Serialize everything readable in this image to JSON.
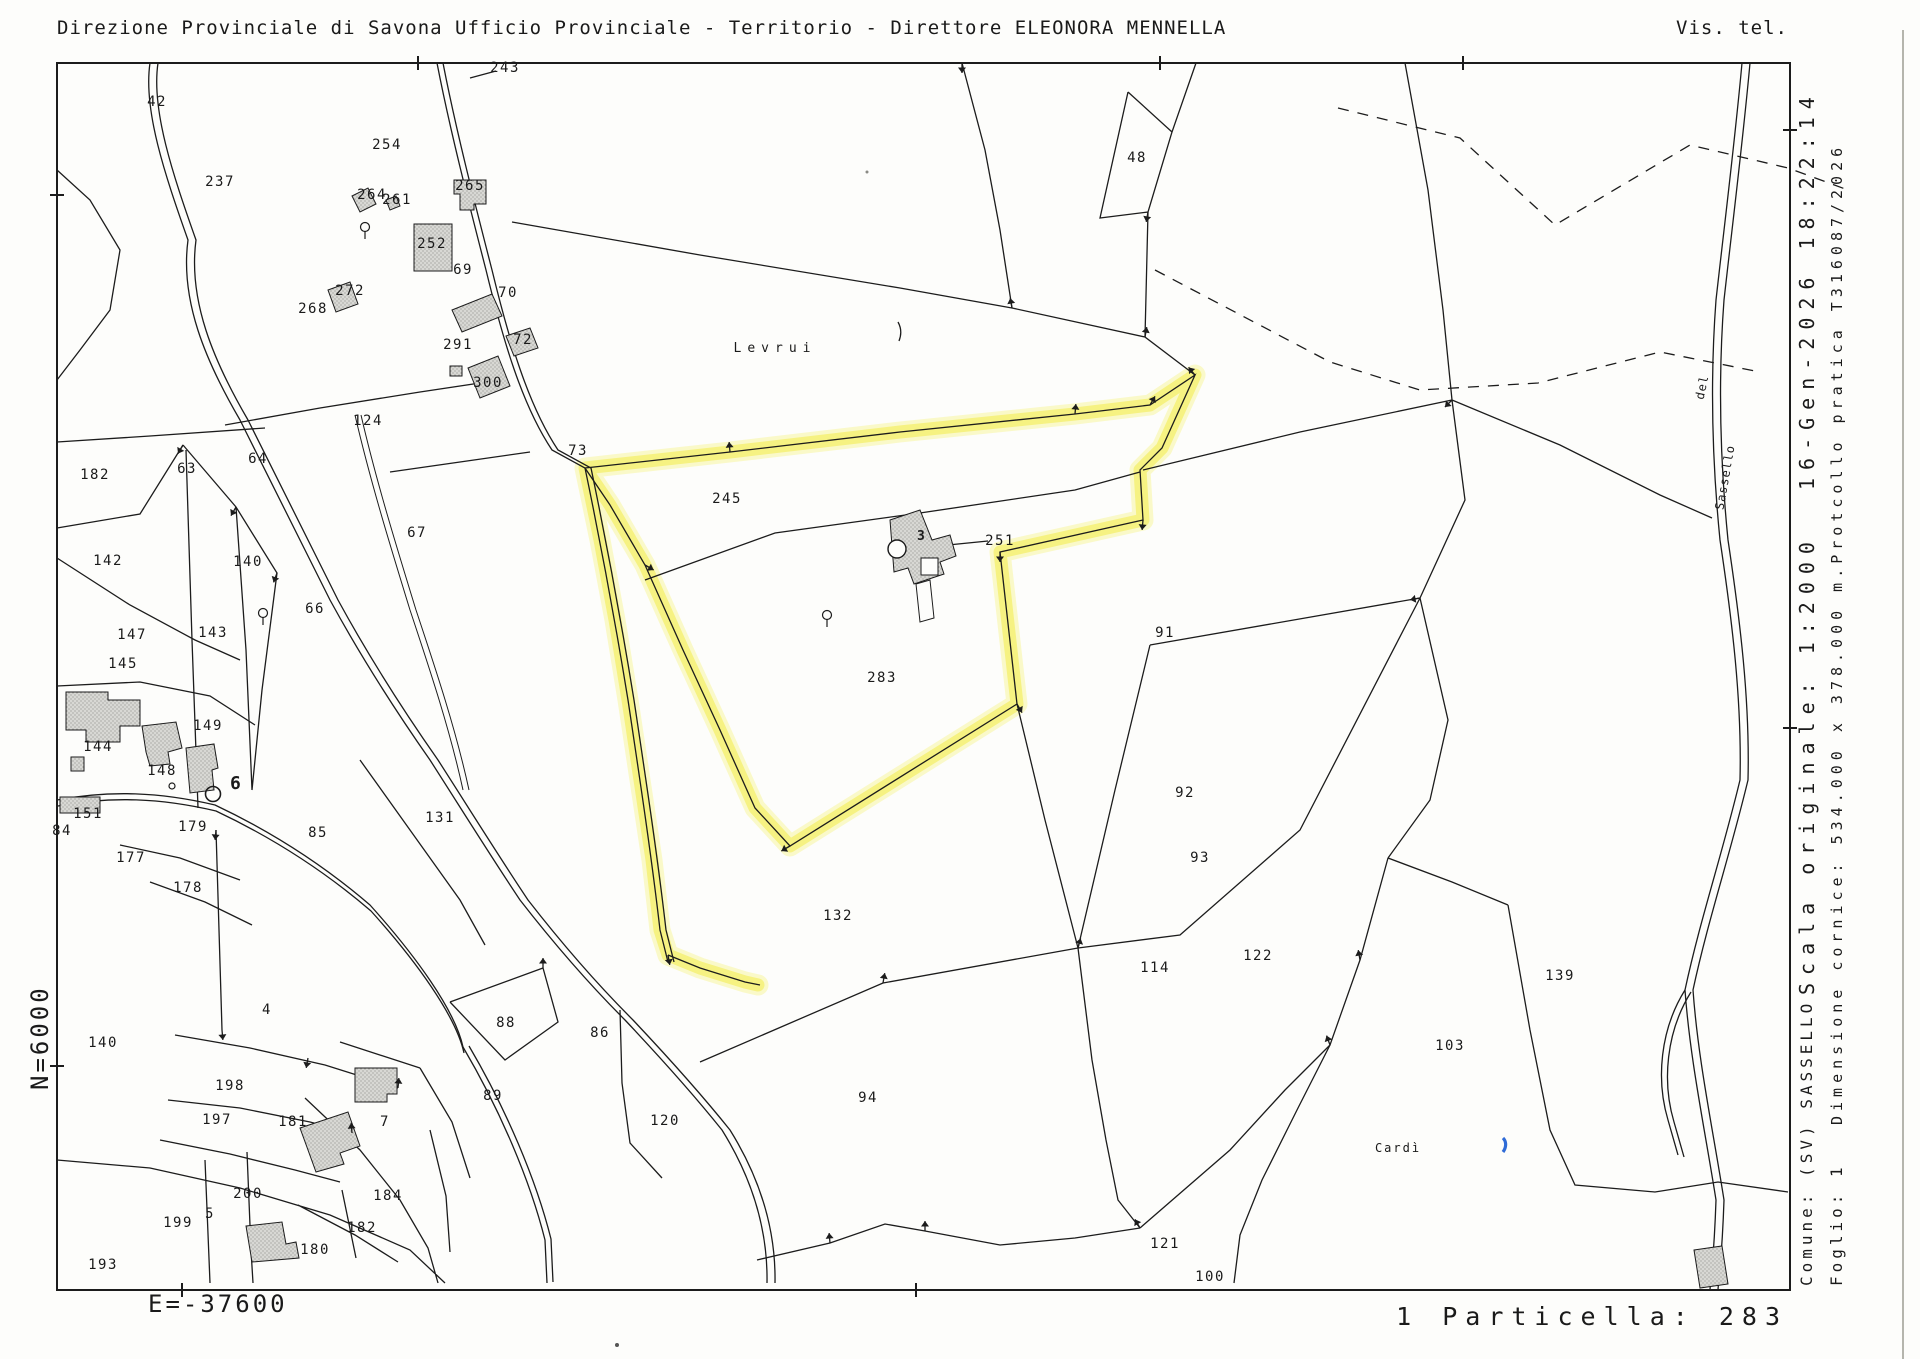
{
  "header": {
    "left": "Direzione Provinciale di Savona  Ufficio Provinciale - Territorio - Direttore ELEONORA MENNELLA",
    "right": "Vis. tel."
  },
  "margins": {
    "north_label": "N=6000",
    "east_label": "E=-37600",
    "datetime_label": "16-Gen-2026 18:22:14",
    "scale_label": "Scala originale: 1:2000",
    "frame_size_label": "Dimensione cornice: 534.000 x 378.000 m.Protcollo pratica T316087/2026",
    "comune_label": "Comune: (SV) SASSELLO",
    "foglio_label": "Foglio: 1",
    "selection_label": "1 Particella: 283"
  },
  "map": {
    "highlighted_parcel": "283",
    "colors": {
      "highlight_yellow": "#f5f17a",
      "line_black": "#1c1c1c",
      "building_gray": "#d8d8d4",
      "blue_mark": "#2f6bd7",
      "paper": "#fdfdfb"
    },
    "parcel_labels": [
      {
        "id": "42",
        "x": 157,
        "y": 106
      },
      {
        "id": "237",
        "x": 220,
        "y": 186
      },
      {
        "id": "254",
        "x": 387,
        "y": 149
      },
      {
        "id": "264",
        "x": 372,
        "y": 199
      },
      {
        "id": "261",
        "x": 397,
        "y": 204
      },
      {
        "id": "265",
        "x": 470,
        "y": 190
      },
      {
        "id": "252",
        "x": 432,
        "y": 248
      },
      {
        "id": "69",
        "x": 463,
        "y": 274
      },
      {
        "id": "70",
        "x": 508,
        "y": 297
      },
      {
        "id": "272",
        "x": 350,
        "y": 295
      },
      {
        "id": "268",
        "x": 313,
        "y": 313
      },
      {
        "id": "291",
        "x": 458,
        "y": 349
      },
      {
        "id": "72",
        "x": 523,
        "y": 344
      },
      {
        "id": "300",
        "x": 488,
        "y": 387
      },
      {
        "id": "124",
        "x": 368,
        "y": 425
      },
      {
        "id": "243",
        "x": 505,
        "y": 72
      },
      {
        "id": "73",
        "x": 578,
        "y": 455
      },
      {
        "id": "245",
        "x": 727,
        "y": 503
      },
      {
        "id": "251",
        "x": 1000,
        "y": 545
      },
      {
        "id": "283",
        "x": 882,
        "y": 682,
        "size": 20
      },
      {
        "id": "48",
        "x": 1137,
        "y": 162
      },
      {
        "id": "182",
        "x": 95,
        "y": 479
      },
      {
        "id": "63",
        "x": 187,
        "y": 473
      },
      {
        "id": "64",
        "x": 258,
        "y": 463
      },
      {
        "id": "142",
        "x": 108,
        "y": 565
      },
      {
        "id": "140",
        "x": 248,
        "y": 566
      },
      {
        "id": "66",
        "x": 315,
        "y": 613
      },
      {
        "id": "67",
        "x": 417,
        "y": 537
      },
      {
        "id": "147",
        "x": 132,
        "y": 639
      },
      {
        "id": "143",
        "x": 213,
        "y": 637
      },
      {
        "id": "145",
        "x": 123,
        "y": 668
      },
      {
        "id": "149",
        "x": 208,
        "y": 730
      },
      {
        "id": "144",
        "x": 98,
        "y": 751
      },
      {
        "id": "148",
        "x": 162,
        "y": 775
      },
      {
        "id": "151",
        "x": 88,
        "y": 818
      },
      {
        "id": "84",
        "x": 62,
        "y": 835
      },
      {
        "id": "179",
        "x": 193,
        "y": 831
      },
      {
        "id": "177",
        "x": 131,
        "y": 862
      },
      {
        "id": "178",
        "x": 188,
        "y": 892
      },
      {
        "id": "85",
        "x": 318,
        "y": 837
      },
      {
        "id": "131",
        "x": 440,
        "y": 822
      },
      {
        "id": "91",
        "x": 1165,
        "y": 637
      },
      {
        "id": "92",
        "x": 1185,
        "y": 797
      },
      {
        "id": "93",
        "x": 1200,
        "y": 862
      },
      {
        "id": "132",
        "x": 838,
        "y": 920
      },
      {
        "id": "114",
        "x": 1155,
        "y": 972
      },
      {
        "id": "122",
        "x": 1258,
        "y": 960
      },
      {
        "id": "94",
        "x": 868,
        "y": 1102
      },
      {
        "id": "120",
        "x": 665,
        "y": 1125
      },
      {
        "id": "86",
        "x": 600,
        "y": 1037
      },
      {
        "id": "88",
        "x": 506,
        "y": 1027
      },
      {
        "id": "89",
        "x": 493,
        "y": 1100
      },
      {
        "id": "4",
        "x": 267,
        "y": 1014
      },
      {
        "id": "140",
        "x": 103,
        "y": 1047
      },
      {
        "id": "198",
        "x": 230,
        "y": 1090
      },
      {
        "id": "197",
        "x": 217,
        "y": 1124
      },
      {
        "id": "181",
        "x": 293,
        "y": 1126
      },
      {
        "id": "7",
        "x": 385,
        "y": 1126
      },
      {
        "id": "200",
        "x": 248,
        "y": 1198
      },
      {
        "id": "5",
        "x": 210,
        "y": 1218
      },
      {
        "id": "199",
        "x": 178,
        "y": 1227
      },
      {
        "id": "193",
        "x": 103,
        "y": 1269
      },
      {
        "id": "184",
        "x": 388,
        "y": 1200
      },
      {
        "id": "182",
        "x": 362,
        "y": 1232
      },
      {
        "id": "180",
        "x": 315,
        "y": 1254
      },
      {
        "id": "121",
        "x": 1165,
        "y": 1248
      },
      {
        "id": "100",
        "x": 1210,
        "y": 1281
      },
      {
        "id": "103",
        "x": 1450,
        "y": 1050
      },
      {
        "id": "139",
        "x": 1560,
        "y": 980
      }
    ],
    "place_labels": [
      {
        "text": "Levrui",
        "x": 775,
        "y": 352,
        "size": 13,
        "ls": 6,
        "rot": 0
      },
      {
        "text": "Cardì",
        "x": 1398,
        "y": 1152,
        "size": 12,
        "ls": 2,
        "rot": 0
      },
      {
        "text": "del",
        "x": 1706,
        "y": 388,
        "size": 12,
        "ls": 1,
        "rot": -78
      },
      {
        "text": "Sassello",
        "x": 1729,
        "y": 478,
        "size": 12,
        "ls": 1,
        "rot": -80
      }
    ],
    "point_symbols": [
      {
        "name": "fiducial-point-number",
        "label": "6",
        "x": 230,
        "y": 789
      },
      {
        "name": "building-annotation-number",
        "label": "3",
        "x": 917,
        "y": 540
      }
    ]
  }
}
